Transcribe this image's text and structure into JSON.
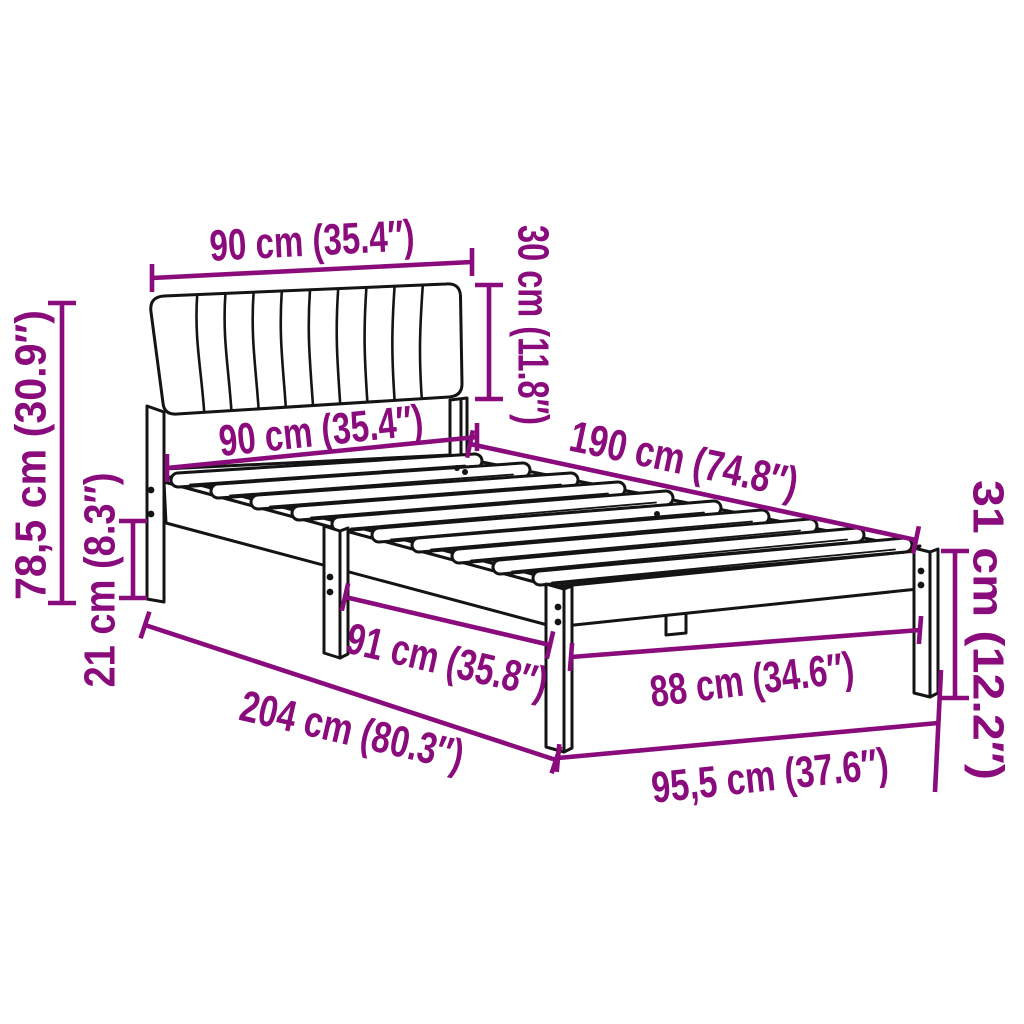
{
  "diagram": {
    "type": "furniture-dimension-diagram",
    "subject": "bed-frame-with-upholstered-headboard",
    "background_color": "#ffffff",
    "outline_color": "#141414",
    "dimension_color": "#8A0B7C",
    "dimensions": [
      {
        "id": "headboard-width",
        "label": "90 cm (35.4″)",
        "value_cm": "90",
        "value_inch": "35.4"
      },
      {
        "id": "headboard-height",
        "label": "30 cm (11.8″)",
        "value_cm": "30",
        "value_inch": "11.8"
      },
      {
        "id": "total-height",
        "label": "78,5 cm (30.9″)",
        "value_cm": "78,5",
        "value_inch": "30.9"
      },
      {
        "id": "frame-width-head",
        "label": "90 cm (35.4″)",
        "value_cm": "90",
        "value_inch": "35.4"
      },
      {
        "id": "frame-length",
        "label": "190 cm (74.8″)",
        "value_cm": "190",
        "value_inch": "74.8"
      },
      {
        "id": "leg-height",
        "label": "21 cm (8.3″)",
        "value_cm": "21",
        "value_inch": "8.3"
      },
      {
        "id": "leg-spacing",
        "label": "91 cm (35.8″)",
        "value_cm": "91",
        "value_inch": "35.8"
      },
      {
        "id": "frame-width-foot",
        "label": "88 cm (34.6″)",
        "value_cm": "88",
        "value_inch": "34.6"
      },
      {
        "id": "total-length",
        "label": "204 cm (80.3″)",
        "value_cm": "204",
        "value_inch": "80.3"
      },
      {
        "id": "total-width",
        "label": "95,5 cm (37.6″)",
        "value_cm": "95,5",
        "value_inch": "37.6"
      },
      {
        "id": "frame-height-foot",
        "label": "31 cm (12.2″)",
        "value_cm": "31",
        "value_inch": "12.2"
      }
    ]
  }
}
